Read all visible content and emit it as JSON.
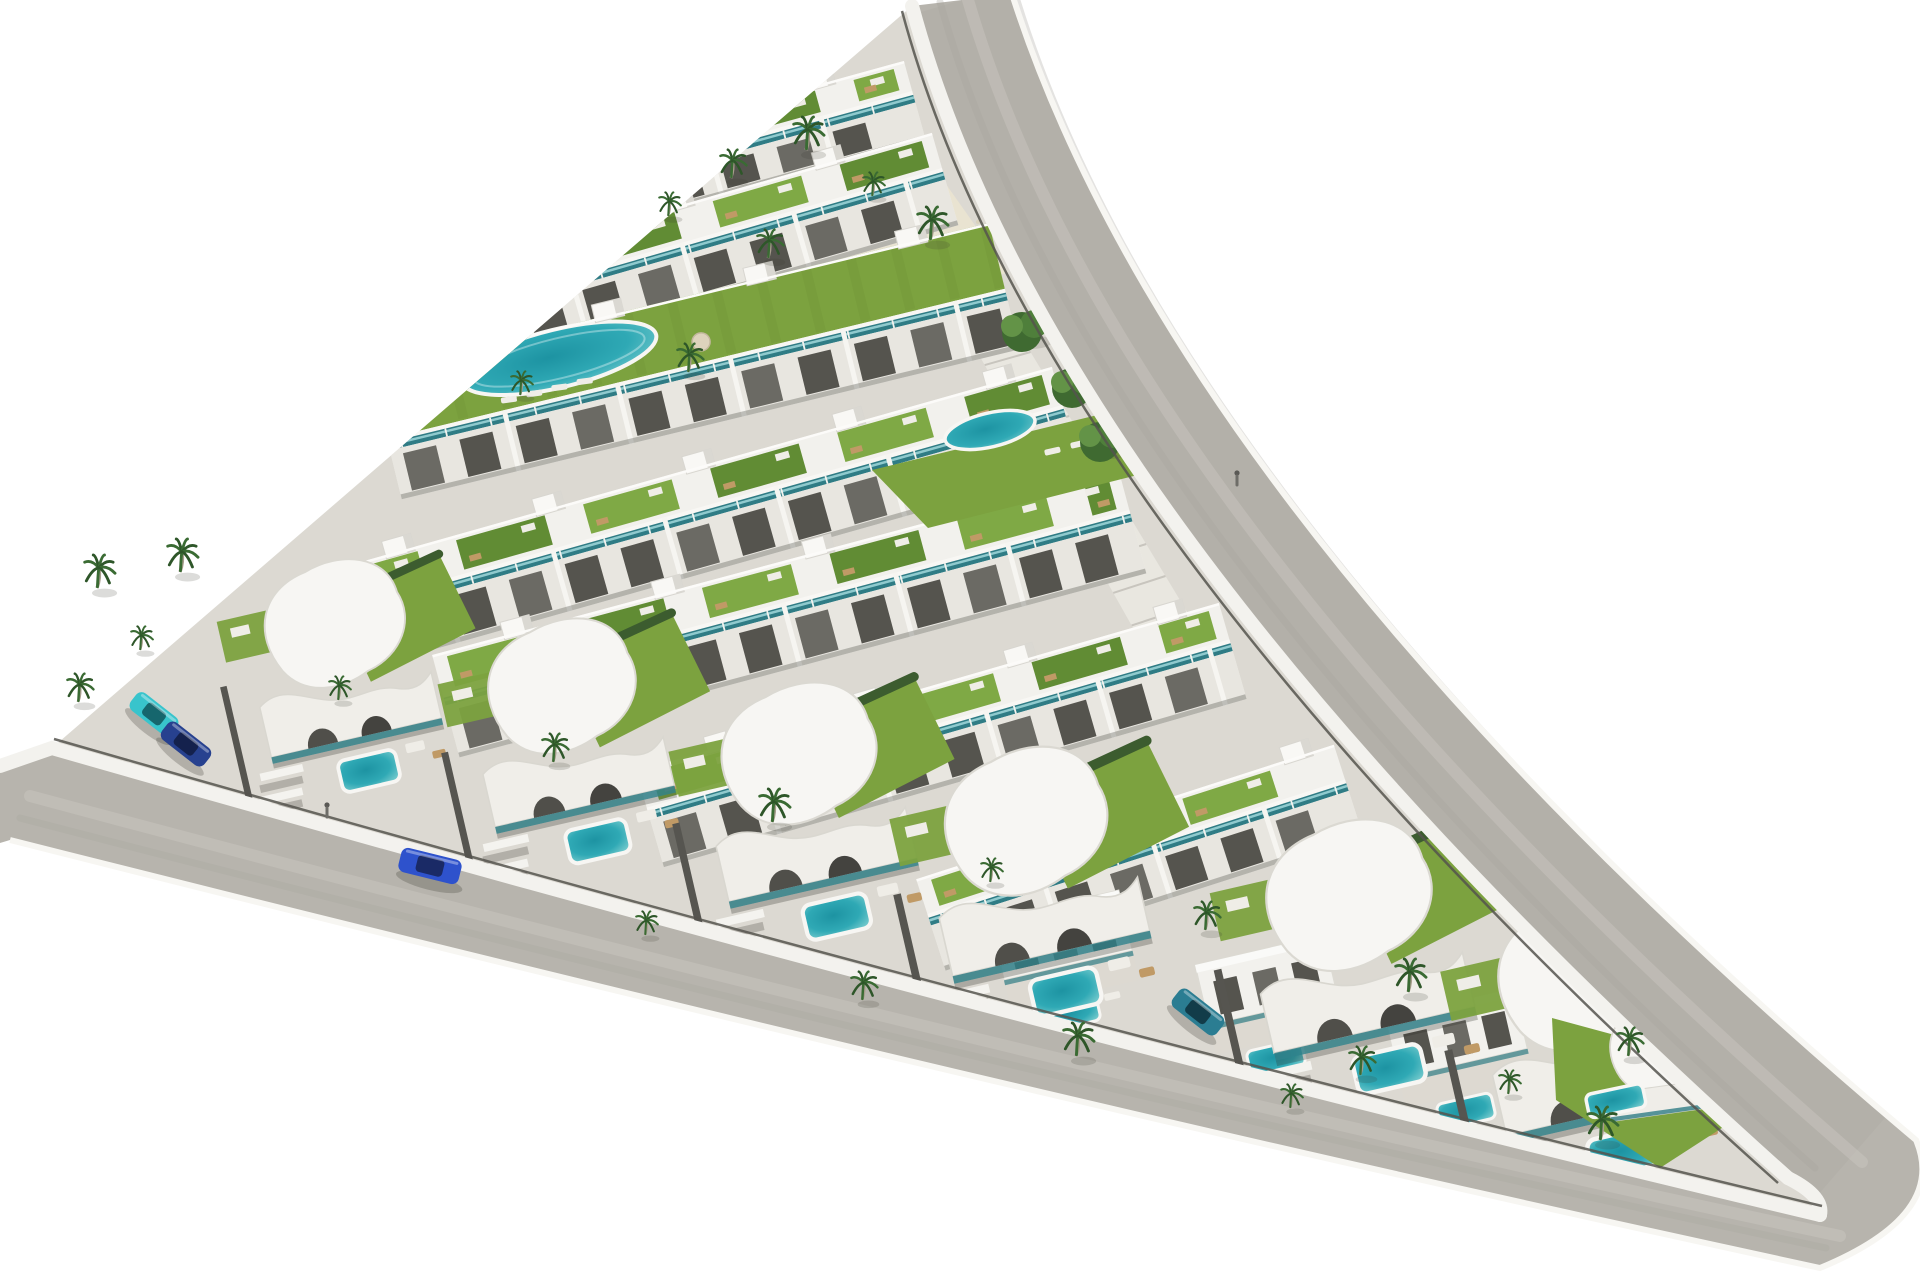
{
  "canvas": {
    "w": 1920,
    "h": 1280,
    "bg": "#ffffff"
  },
  "palette": {
    "road": "#b7b4ad",
    "road_light": "#cbc8c1",
    "road_dark": "#a5a29b",
    "curb": "#f3f2ee",
    "fence": "#55544e",
    "site": "#dcd9d2",
    "site_light": "#e7e5de",
    "building": "#f2f1ed",
    "building_shade": "#d9d7d0",
    "facade": "#e8e6e0",
    "window_dark": "#55544e",
    "window_mid": "#6b6a64",
    "roof_green": "#7fa945",
    "roof_green_dark": "#618c34",
    "lawn": "#7ca23f",
    "hedge": "#3c5c2f",
    "pool_deep": "#1d93a2",
    "pool_mid": "#2fa9b5",
    "pool_light": "#8ad4d4",
    "coping": "#f7f6f3",
    "balustrade": "#2f7c85",
    "glass": "#a7dde0",
    "sand": "#e9e3d1",
    "sand_dot": "#d8d0ba",
    "palm_frond": "#3a6b33",
    "palm_frond_dark": "#2e5629",
    "trunk": "#a79d8c",
    "tree_dark": "#3f6a31",
    "tree_mid": "#4f7f3b",
    "tree_light": "#639347",
    "parasol": "#ddd3bc",
    "wood": "#c09a66",
    "white_furniture": "#efede7",
    "shadow": "rgba(45,45,40,0.28)"
  },
  "roads": {
    "band_path": "M912 6 L1012 -6 Q1180 520 1916 1140 Q1948 1215 1820 1268 Q1005 1092 10 840 L0 843 L0 766 L52 748 Q1000 1020 1820 1215 Q1824 1196 1788 1178 Q1050 520 912 6 Z",
    "right_tint_path": "M962 0 Q1115 520 1850 1158",
    "outer_edge_path": "M1012 -6 Q1180 520 1916 1140 Q1948 1215 1820 1268 Q1005 1092 10 840",
    "sidewalks": [
      "M912 6 Q1050 520 1788 1178",
      "M0 766 L52 748 Q1000 1020 1820 1215",
      "M1788 1178 Q1824 1196 1820 1215"
    ],
    "fences": [
      {
        "path": "M912 6 Q1050 520 1788 1178",
        "dx": -10,
        "dy": 5
      },
      {
        "path": "M52 748 Q1000 1020 1820 1215",
        "dx": 2,
        "dy": -9
      }
    ],
    "stripes": [
      {
        "path": "M968 0 Q1120 520 1862 1162",
        "w": 12,
        "color": "road_light",
        "op": 0.45
      },
      {
        "path": "M940 2 Q1085 520 1815 1168",
        "w": 7,
        "color": "road_dark",
        "op": 0.3
      },
      {
        "path": "M30 796 Q1004 1058 1840 1236",
        "w": 12,
        "color": "road_light",
        "op": 0.45
      },
      {
        "path": "M20 818 Q1004 1074 1826 1248",
        "w": 7,
        "color": "road_dark",
        "op": 0.25
      }
    ]
  },
  "site": {
    "path": "M912 6 Q1050 520 1788 1178 Q1824 1196 1820 1215 Q1000 1020 52 748 Z"
  },
  "plaza": {
    "points": "624,266 895,112 1008,272 792,362",
    "dots": 14
  },
  "stairs": {
    "points": "948,300 992,288 1204,640 1150,658",
    "steps": 11
  },
  "rows": [
    {
      "x1": 588,
      "y1": 148,
      "x2": 900,
      "y2": 62,
      "d": 82
    },
    {
      "x1": 448,
      "y1": 272,
      "x2": 928,
      "y2": 134,
      "d": 96
    },
    {
      "x1": 375,
      "y1": 372,
      "x2": 985,
      "y2": 224,
      "d": 130,
      "deck": true,
      "pool": {
        "cx": 182,
        "cy": 30,
        "rx": 100,
        "ry": 29
      }
    },
    {
      "x1": 318,
      "y1": 574,
      "x2": 1048,
      "y2": 368,
      "d": 104
    },
    {
      "x1": 436,
      "y1": 654,
      "x2": 1115,
      "y2": 472,
      "d": 106
    },
    {
      "x1": 640,
      "y1": 770,
      "x2": 1215,
      "y2": 604,
      "d": 100
    },
    {
      "x1": 920,
      "y1": 878,
      "x2": 1330,
      "y2": 746,
      "d": 96
    }
  ],
  "lawn2": {
    "points": "872,470 1200,390 1252,446 928,528"
  },
  "oval_pool": {
    "cx": 990,
    "cy": 430,
    "rx": 46,
    "ry": 17,
    "rot": -13
  },
  "lawn2_chairs": [
    [
      1044,
      450
    ],
    [
      1070,
      443
    ],
    [
      1096,
      436
    ]
  ],
  "villas": [
    {
      "x": 200,
      "y": 575,
      "s": 0.95
    },
    {
      "x": 420,
      "y": 635,
      "s": 1.0
    },
    {
      "x": 650,
      "y": 700,
      "s": 1.05
    },
    {
      "x": 870,
      "y": 765,
      "s": 1.1
    },
    {
      "x": 1190,
      "y": 838,
      "s": 1.12
    },
    {
      "x": 1420,
      "y": 915,
      "s": 1.15
    }
  ],
  "small_villas": [
    {
      "x": 990,
      "y": 920
    },
    {
      "x": 1195,
      "y": 965
    },
    {
      "x": 1385,
      "y": 1018
    }
  ],
  "corner": {
    "lawn": "1552,1018 1692,1056 1728,1124 1660,1168 1556,1100",
    "villa": {
      "x": 1566,
      "y": 1002,
      "s": 0.7,
      "rot": -8
    },
    "pool": {
      "x": 1585,
      "y": 1095,
      "w": 58,
      "h": 24,
      "rot": -12
    }
  },
  "trees": [
    [
      1022,
      332
    ],
    [
      1072,
      388
    ],
    [
      1100,
      442
    ]
  ],
  "palms": [
    [
      668,
      216
    ],
    [
      731,
      178
    ],
    [
      806,
      150
    ],
    [
      872,
      196
    ],
    [
      768,
      258
    ],
    [
      930,
      240
    ],
    [
      520,
      395
    ],
    [
      688,
      372
    ],
    [
      97,
      588
    ],
    [
      140,
      650
    ],
    [
      78,
      702
    ],
    [
      180,
      572
    ],
    [
      338,
      700
    ],
    [
      553,
      762
    ],
    [
      772,
      822
    ],
    [
      990,
      882
    ],
    [
      1205,
      930
    ],
    [
      1408,
      992
    ],
    [
      645,
      935
    ],
    [
      862,
      1000
    ],
    [
      1076,
      1056
    ],
    [
      1290,
      1108
    ],
    [
      1628,
      1056
    ],
    [
      1600,
      1140
    ],
    [
      1508,
      1094
    ],
    [
      1360,
      1075
    ]
  ],
  "cars": [
    {
      "name": "car-blue-on-road",
      "x": 430,
      "y": 866,
      "rot": 14,
      "len": 62,
      "wid": 25,
      "body": "#2e52cc",
      "win": "#1a2a66"
    },
    {
      "name": "car-teal-parked",
      "x": 154,
      "y": 714,
      "rot": 38,
      "len": 52,
      "wid": 22,
      "body": "#38c4cc",
      "win": "#16666d"
    },
    {
      "name": "car-navy-parked",
      "x": 186,
      "y": 744,
      "rot": 38,
      "len": 54,
      "wid": 22,
      "body": "#27418f",
      "win": "#14214d"
    },
    {
      "name": "car-dark-teal",
      "x": 1198,
      "y": 1012,
      "rot": 38,
      "len": 56,
      "wid": 23,
      "body": "#2b7d92",
      "win": "#123c49"
    }
  ],
  "people": [
    [
      327,
      814
    ],
    [
      1237,
      482
    ]
  ]
}
